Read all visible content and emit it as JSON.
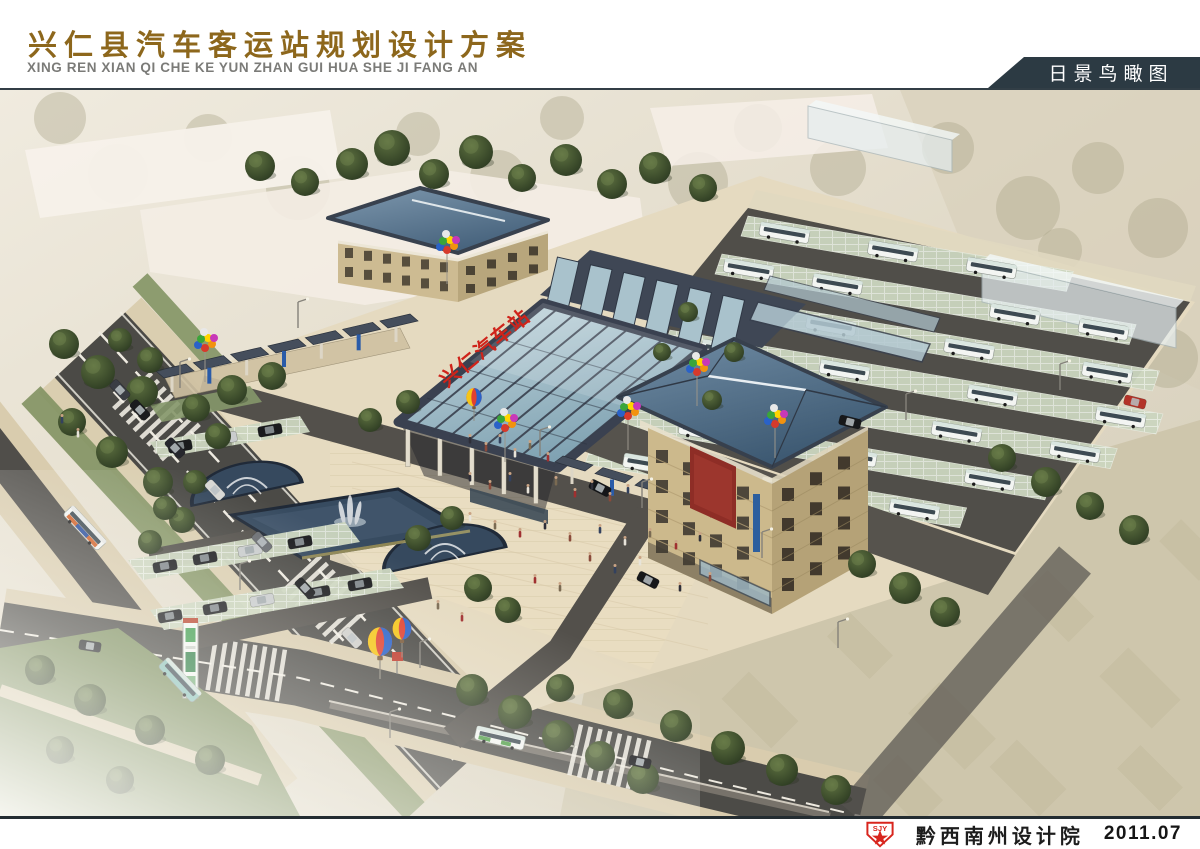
{
  "header": {
    "title": "兴仁县汽车客运站规划设计方案",
    "subtitle_pinyin": "XING REN XIAN QI CHE KE YUN ZHAN GUI HUA SHE JI FANG AN",
    "view_label": "日景鸟瞰图"
  },
  "rendering": {
    "station_sign": "兴仁汽车站"
  },
  "footer": {
    "logo_text": "SJY",
    "company": "黔西南州设计院",
    "date": "2011.07"
  },
  "colors": {
    "title_brown": "#8d671c",
    "label_bg": "#2c3a43",
    "logo_red": "#d8251d",
    "roof_blue": "#4c6a86",
    "glass_blue": "#9db8c2",
    "water_blue": "#374b60",
    "footer_text": "#1d1d1d"
  }
}
